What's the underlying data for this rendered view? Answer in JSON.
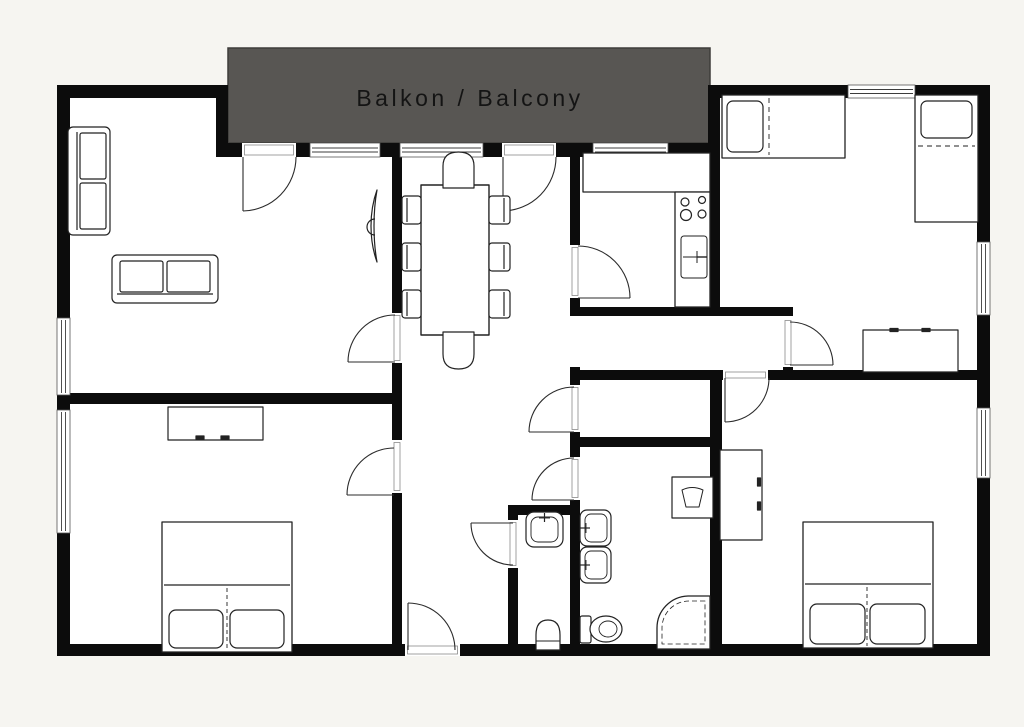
{
  "balcony": {
    "label": "Balkon / Balcony"
  },
  "colors": {
    "page_background": "#f6f5f1",
    "floor": "#ffffff",
    "wall": "#0c0c0c",
    "balcony_fill": "#585653",
    "balcony_border": "#3e3d3b",
    "balcony_text": "#141414",
    "furniture_line": "#222222"
  },
  "legend": {
    "rooms": [
      "balcony",
      "living-room",
      "dining-area",
      "kitchen",
      "bedroom-top-right",
      "bedroom-bottom-left",
      "bedroom-bottom-right",
      "hallway",
      "corridor",
      "storage-room",
      "bathroom",
      "wc"
    ],
    "furniture": [
      "sofa",
      "tv",
      "dining-table",
      "dining-chair",
      "kitchen-counter",
      "stove",
      "kitchen-sink",
      "single-bed",
      "double-bed",
      "sideboard",
      "dresser",
      "wardrobe",
      "washbasin",
      "toilet",
      "corner-shower",
      "washing-machine"
    ],
    "openings": [
      "balcony-door",
      "room-door",
      "entrance-door",
      "window"
    ]
  }
}
